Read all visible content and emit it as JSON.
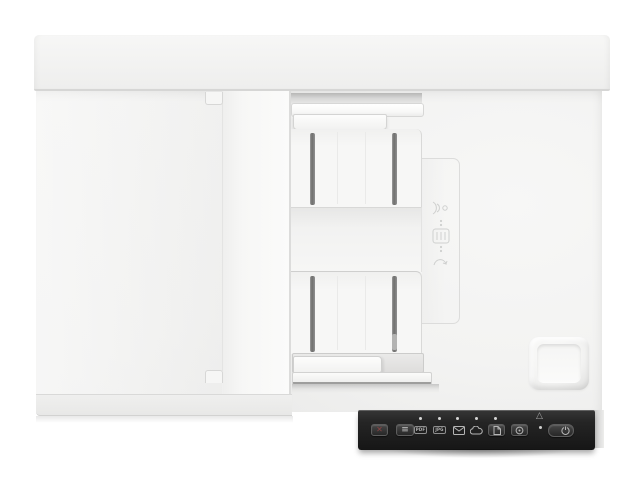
{
  "scene": {
    "type": "product-photo",
    "subject": "White flatbed document scanner with automatic document feeder, viewed from above",
    "background_color": "#ffffff"
  },
  "colors": {
    "body_white": "#f2f2f1",
    "bright_white": "#fbfbfa",
    "edge_gray": "#d7d7d6",
    "slot_dark": "#6e6e6d",
    "panel_black": "#1d1d1d",
    "button_face": "#3a3a3a",
    "glyph_gray": "#b8b8b8",
    "cancel_red": "#8c4444",
    "led_white": "#d6d6d5"
  },
  "control_panel": {
    "cancel": {
      "glyph": "✕"
    },
    "options": {
      "glyph": "≡"
    },
    "indicators": [
      {
        "id": "pdf",
        "label": "PDF"
      },
      {
        "id": "jpg",
        "label": "JPG"
      },
      {
        "id": "email",
        "icon": "envelope-icon"
      },
      {
        "id": "cloud",
        "icon": "cloud-icon"
      }
    ],
    "scan_file": {
      "icon": "document-icon"
    },
    "duplex": {
      "icon": "duplex-circle-icon"
    },
    "error": {
      "glyph": "△"
    },
    "power": {
      "icon": "power-icon"
    }
  },
  "embossed_icons": [
    {
      "id": "ultrasonic-sensor"
    },
    {
      "id": "paper-load-guide"
    },
    {
      "id": "page-curve"
    }
  ]
}
